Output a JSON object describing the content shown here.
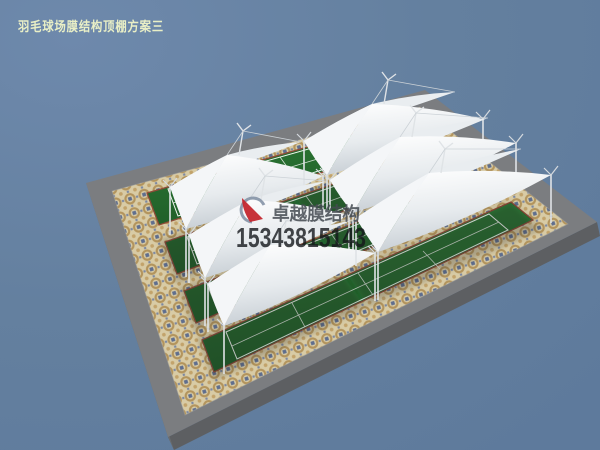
{
  "title": {
    "text": "羽毛球场膜结构顶棚方案三"
  },
  "watermark": {
    "brand": "卓越膜结构",
    "phone": "15343815143",
    "logo_icon": "swoosh-logo"
  },
  "scene": {
    "type": "3d-render",
    "subject": "badminton court membrane canopy structures",
    "canopy_count": 6,
    "court_strip_count": 4
  },
  "colors": {
    "background": "#64809f",
    "background_light": "#6e89ac",
    "title_text": "#e9efc6",
    "brand_text": "#454b52",
    "phone_text": "#15181c",
    "membrane_white": "#fbfcfd",
    "membrane_shade": "#c9d0d6",
    "court_green_dark": "#28712f",
    "court_green_light": "#55a055",
    "court_line": "#f2f7f2",
    "curb_red": "#8f4a38",
    "mosaic_base": "#d8cba5",
    "mosaic_ring": "#b3945c",
    "mosaic_blue": "#5f6e8e",
    "apron_gray": "#7b7d80",
    "apron_side": "#5d5f62",
    "mast_gray": "#dfe3e6",
    "logo_red": "#c4272e",
    "logo_blue": "#8593a6"
  }
}
